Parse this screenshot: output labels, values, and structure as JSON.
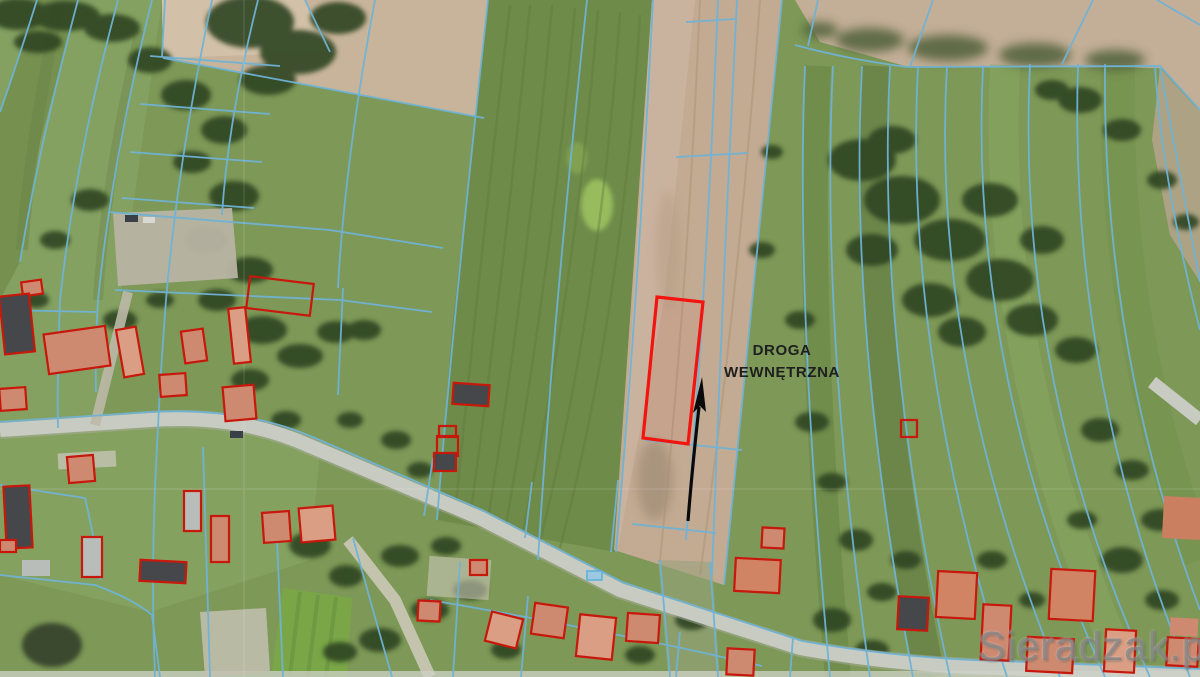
{
  "annotation": {
    "road_label": {
      "line1": "DROGA",
      "line2": "WEWNĘTRZNA"
    },
    "arrow_icon": "arrow-up-icon"
  },
  "watermark": {
    "text": "Sieradzak.pl"
  },
  "colors": {
    "parcel_boundary_line": "#6fb3d6",
    "highlighted_parcel_outline": "#f3140f",
    "building_outline": "#c8170b",
    "annotation_arrow": "#0a0a0a",
    "annotation_text": "#1f1f1f"
  }
}
